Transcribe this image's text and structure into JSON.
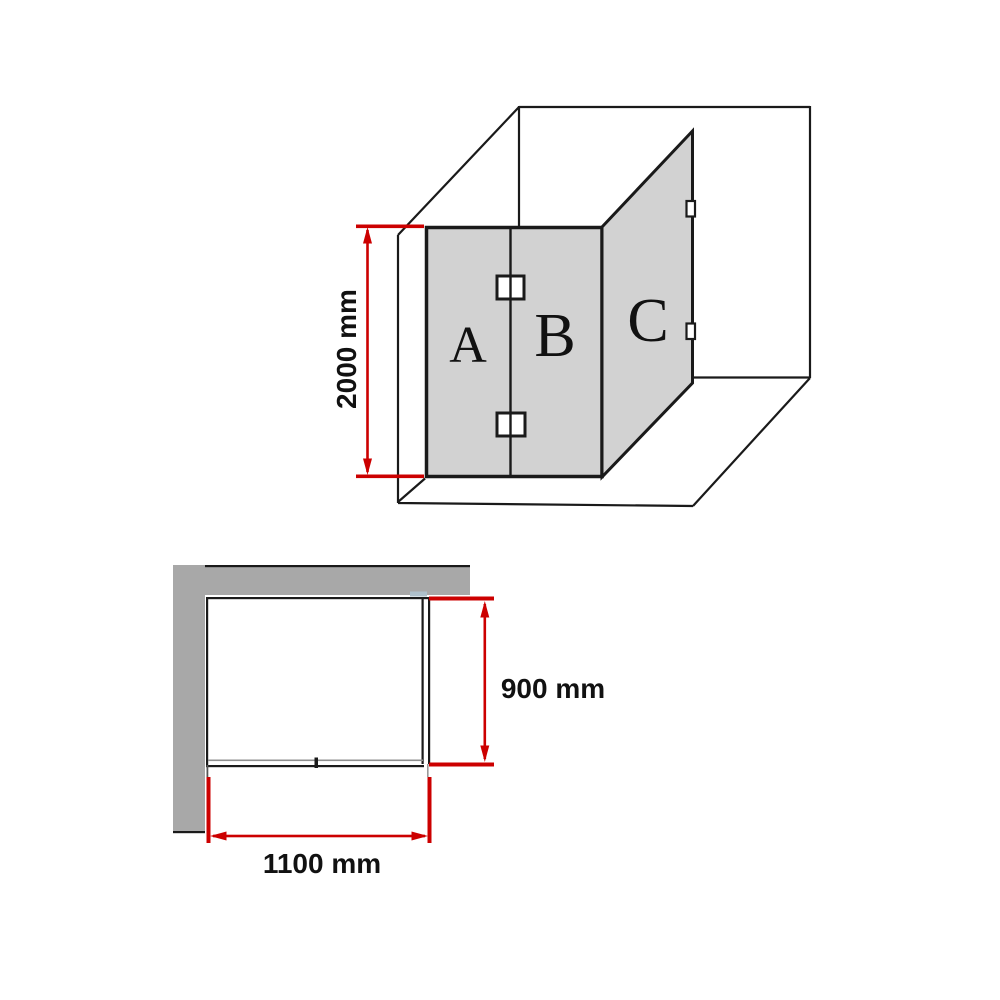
{
  "diagram": {
    "type": "shower-screen-dimension-spec",
    "panels": {
      "a": "A",
      "b": "B",
      "c": "C"
    },
    "dimensions": {
      "height": "2000 mm",
      "depth": "900 mm",
      "width": "1100 mm"
    },
    "values_mm": {
      "height": 2000,
      "depth": 900,
      "width": 1100
    },
    "colors": {
      "dimension_red": "#cc0000",
      "glass_fill": "#d2d2d2",
      "wall_fill": "#a8a8a8",
      "line": "#1a1a1a",
      "background": "#ffffff"
    }
  }
}
